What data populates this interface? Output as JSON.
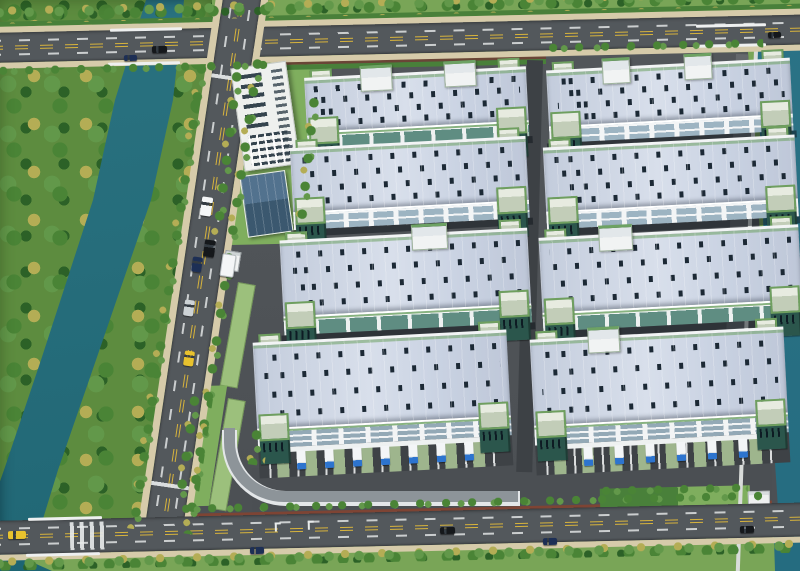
{
  "scene": {
    "type": "aerial-architectural-rendering",
    "subject": "industrial logistics park with warehouses, canal, perimeter roads and landscaping",
    "warehouses": {
      "rows": 4,
      "columns": 2,
      "total": 8,
      "roof_color": "#c7d0e0",
      "skylight_color": "#1c2935",
      "stair_tower_body_color": "#2b564c",
      "stair_tower_cap_color": "#c9d3c2",
      "trim_green": "#6da263"
    },
    "office_tower": {
      "wall_color": "#eef0ee",
      "window_color": "#35444e"
    },
    "annex_building": {
      "roof_color": "#46617a"
    },
    "loading_docks": {
      "left_building_trucks": 7,
      "right_building_trucks": 6,
      "truck_cab_color": "#2d74cf",
      "truck_body_color": "#f3f5f7",
      "dock_lane_color": "#a9c295"
    },
    "roads": {
      "surface_color": "#53585c",
      "lane_line_white": "#e9ecec",
      "lane_line_yellow": "#d7b33c",
      "sidewalk_color": "#d6cbaa"
    },
    "water": {
      "canal_color": "#26727f",
      "right_river_color": "#2b7386"
    },
    "vegetation": {
      "grass_color": "#79a557",
      "lawn_color": "#7fae5e",
      "forest_base": "#5d8c3f",
      "tree_green": "#4a8436",
      "tree_green_light": "#62984a",
      "tree_green_dark": "#2c6127",
      "tree_yellow": "#b4ad55",
      "hedge_color": "#49803a"
    },
    "boundary_wall_color": "#7e4434",
    "ramp_color": "#8d9499",
    "vehicles": {
      "car_count": 13,
      "colors": {
        "black": "#15181b",
        "navy": "#1d2f55",
        "silver": "#cdd3d6",
        "white": "#f4f6f7",
        "taxi_yellow": "#e8c22e"
      }
    }
  }
}
